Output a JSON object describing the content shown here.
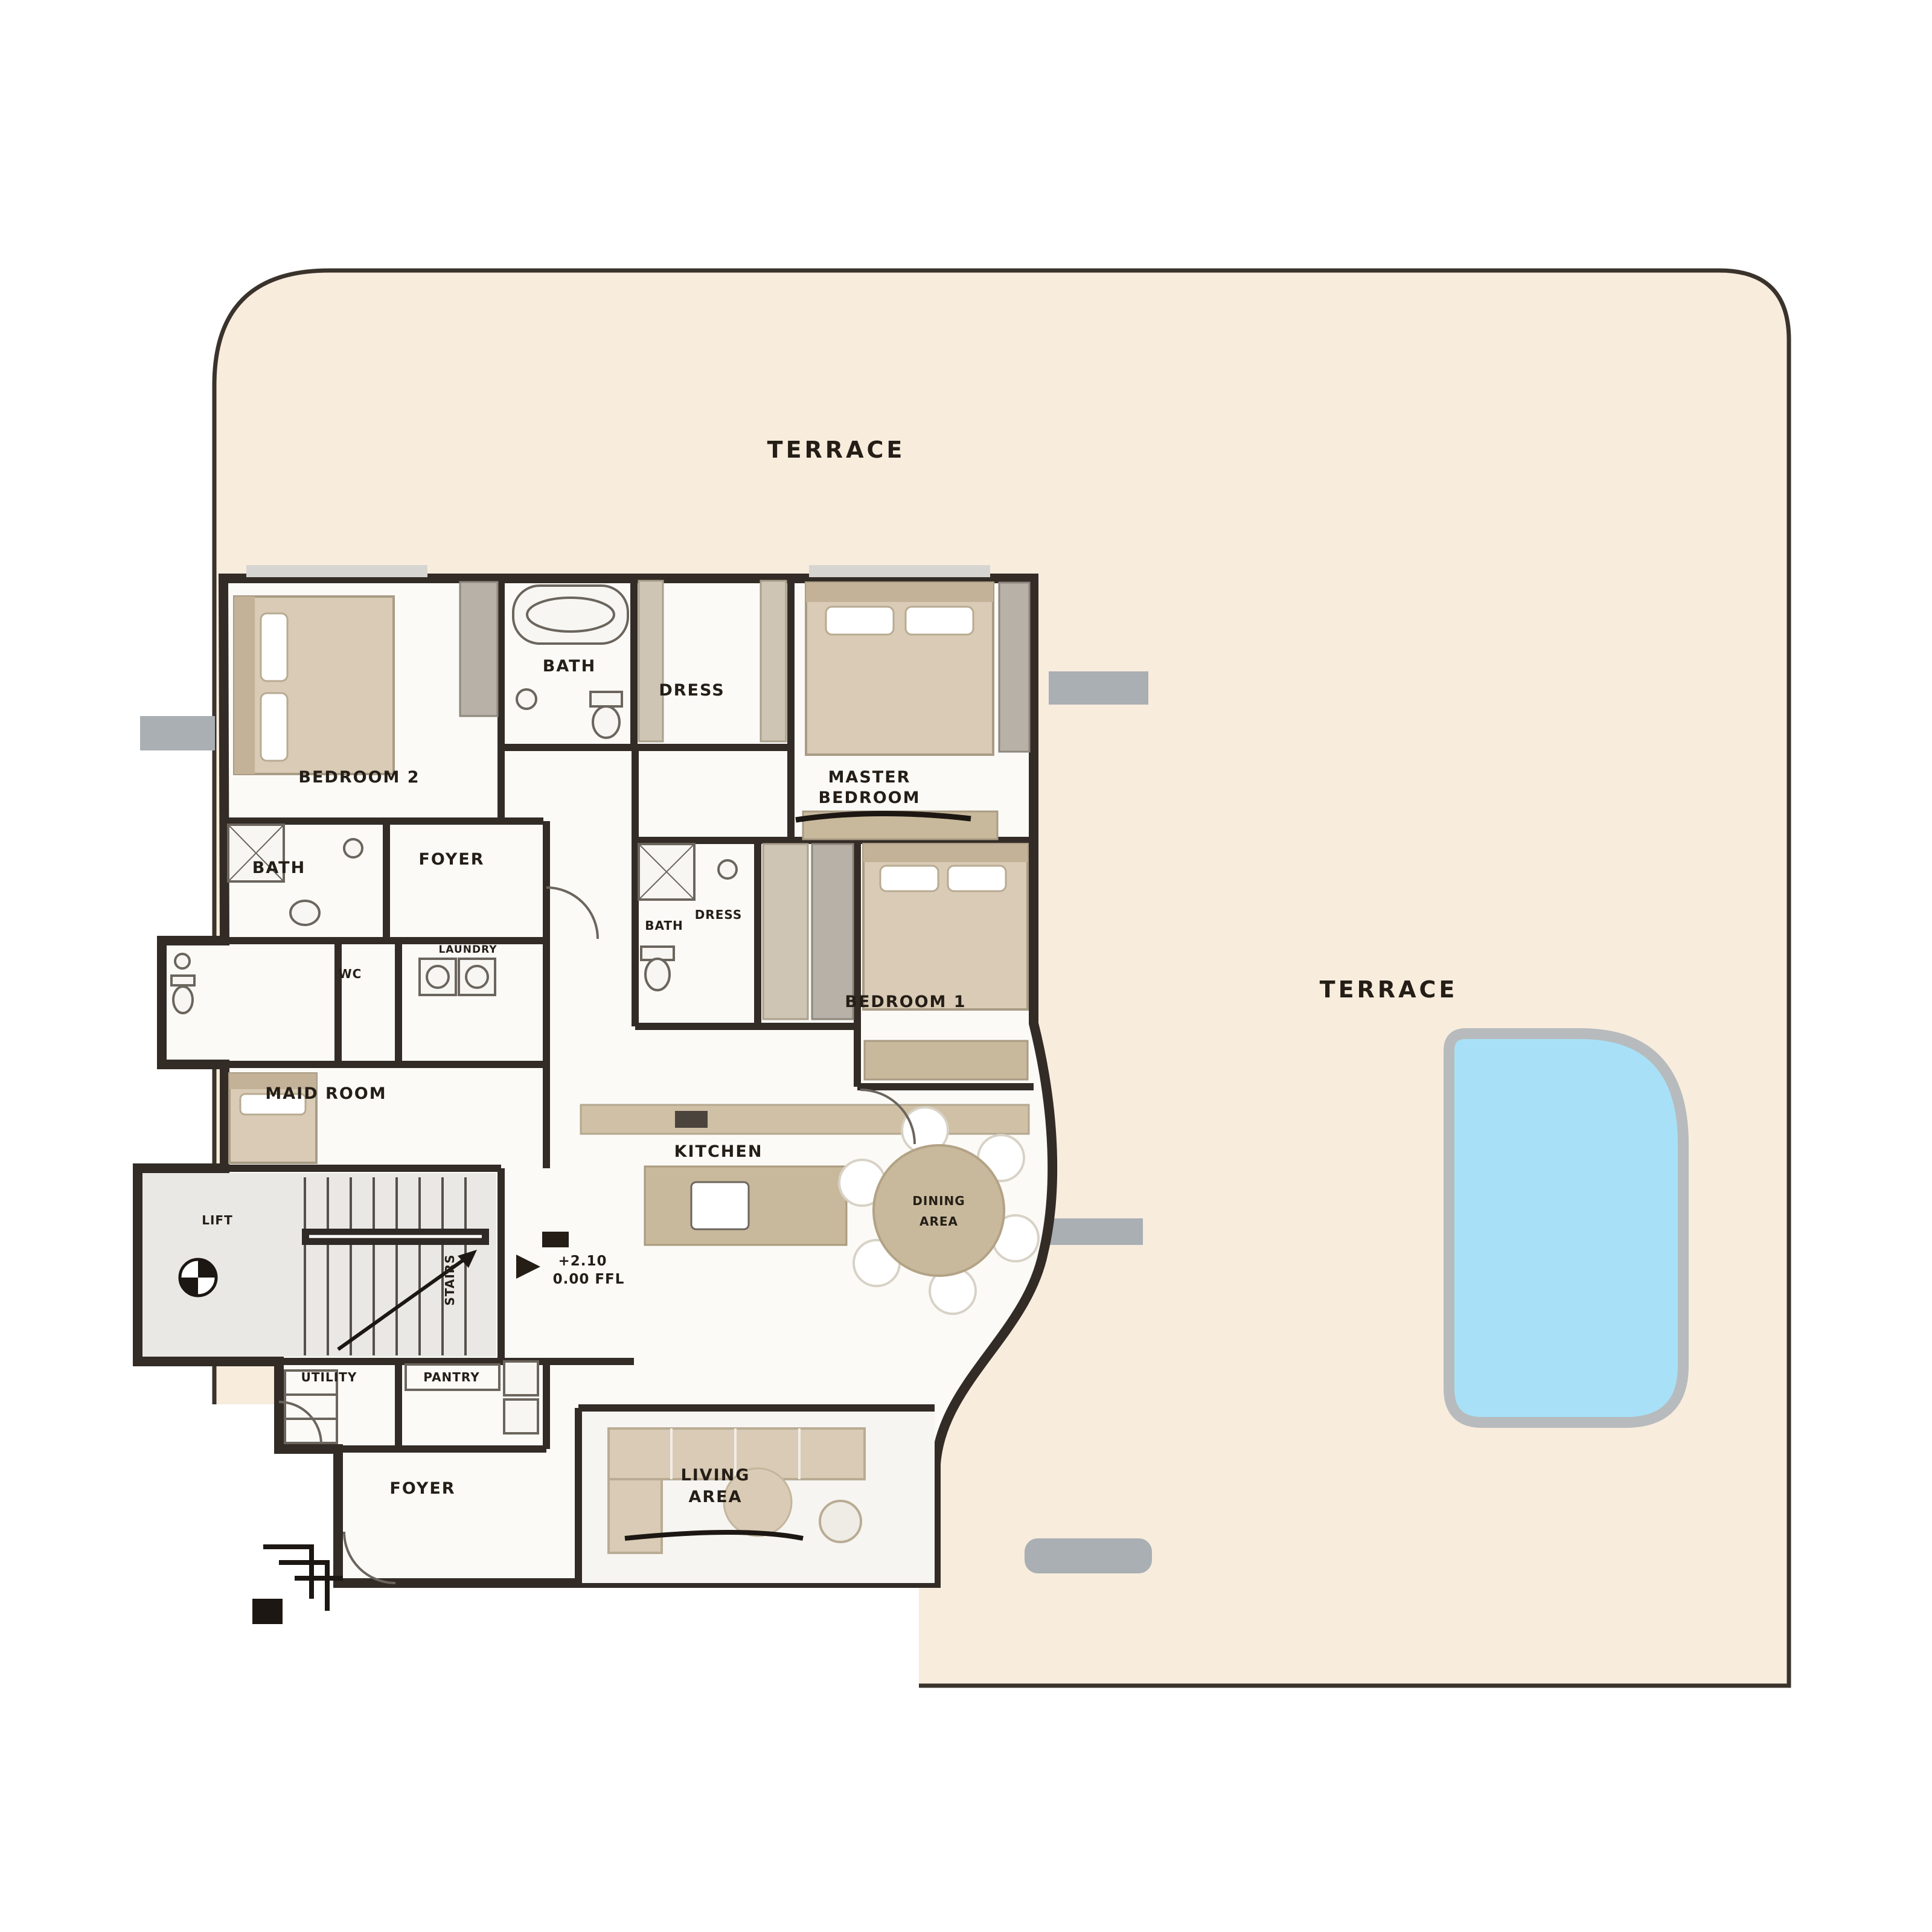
{
  "plan": {
    "type": "penthouse-floor-plan",
    "labels": {
      "terrace_top": "TERRACE",
      "terrace_right": "TERRACE",
      "bedroom2": "BEDROOM 2",
      "bath_top": "BATH",
      "dress_top": "DRESS",
      "master_line1": "MASTER",
      "master_line2": "BEDROOM",
      "bath_small": "BATH",
      "foyer_mid": "FOYER",
      "wc": "WC",
      "laundry": "LAUNDRY",
      "bath2": "BATH",
      "dress2": "DRESS",
      "bedroom1": "BEDROOM 1",
      "maid_room": "MAID ROOM",
      "lift": "LIFT",
      "stairs": "STAIRS",
      "utility": "UTILITY",
      "pantry": "PANTRY",
      "entry_foyer": "FOYER",
      "kitchen": "KITCHEN",
      "dining_line1": "DINING",
      "dining_line2": "AREA",
      "living_line1": "LIVING",
      "living_line2": "AREA",
      "level_line1": "+2.10",
      "level_line2": "0.00 FFL"
    },
    "colors": {
      "terrace_fill": "#f8ecdd",
      "pool_water": "#a8e1f7",
      "pool_rim": "#b7bbbd",
      "wall": "#332c26",
      "room_fill": "#fbfaf7",
      "stair_fill": "#e9e8e5",
      "furniture_tan": "#d9cbb5",
      "counter_tan": "#c9b99c",
      "ledge_gray": "#a9afb3",
      "text": "#241e17"
    }
  }
}
